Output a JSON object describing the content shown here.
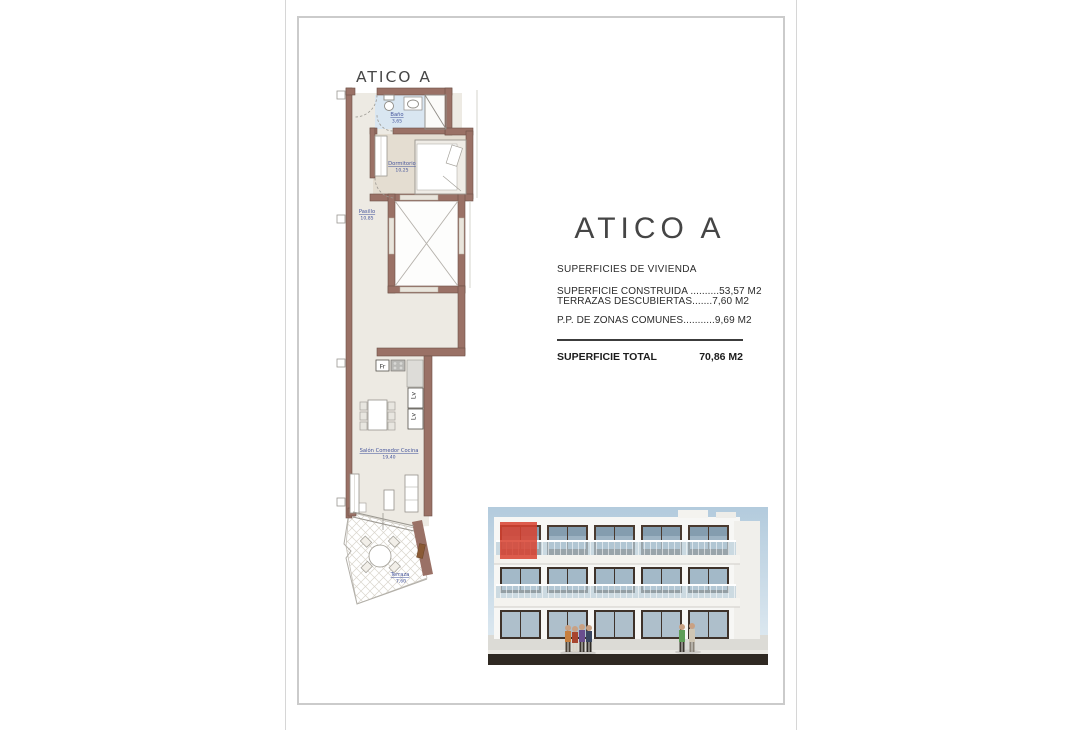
{
  "floor_plan": {
    "title": "ATICO A",
    "rooms": [
      {
        "name": "Baño",
        "area": "3,65"
      },
      {
        "name": "Dormitorio",
        "area": "10,25"
      },
      {
        "name": "Pasillo",
        "area": "10,85"
      },
      {
        "name": "Salón Comedor Cocina",
        "area": "19,40"
      },
      {
        "name": "Terraza",
        "area": "7,60"
      }
    ],
    "appliances": {
      "fridge": "Fr",
      "washer": "Lv",
      "dishwasher": "Lv"
    }
  },
  "spec": {
    "title": "ATICO A",
    "section_heading": "SUPERFICIES DE VIVIENDA",
    "rows": [
      {
        "label": "SUPERFICIE CONSTRUIDA ..........",
        "value": "53,57 M2"
      },
      {
        "label": "TERRAZAS DESCUBIERTAS.......",
        "value": "7,60 M2"
      },
      {
        "label": "P.P. DE ZONAS COMUNES...........",
        "value": "9,69 M2"
      }
    ],
    "total_label": "SUPERFICIE TOTAL",
    "total_value": "70,86 M2"
  },
  "colors": {
    "wall": "#9a7166",
    "bathroom_floor": "#d9e6f1",
    "room_floor": "#edeae3",
    "bedroom_floor": "#e4ddd1",
    "label_blue": "#44549b",
    "unit_highlight_red": "#d8412f"
  }
}
